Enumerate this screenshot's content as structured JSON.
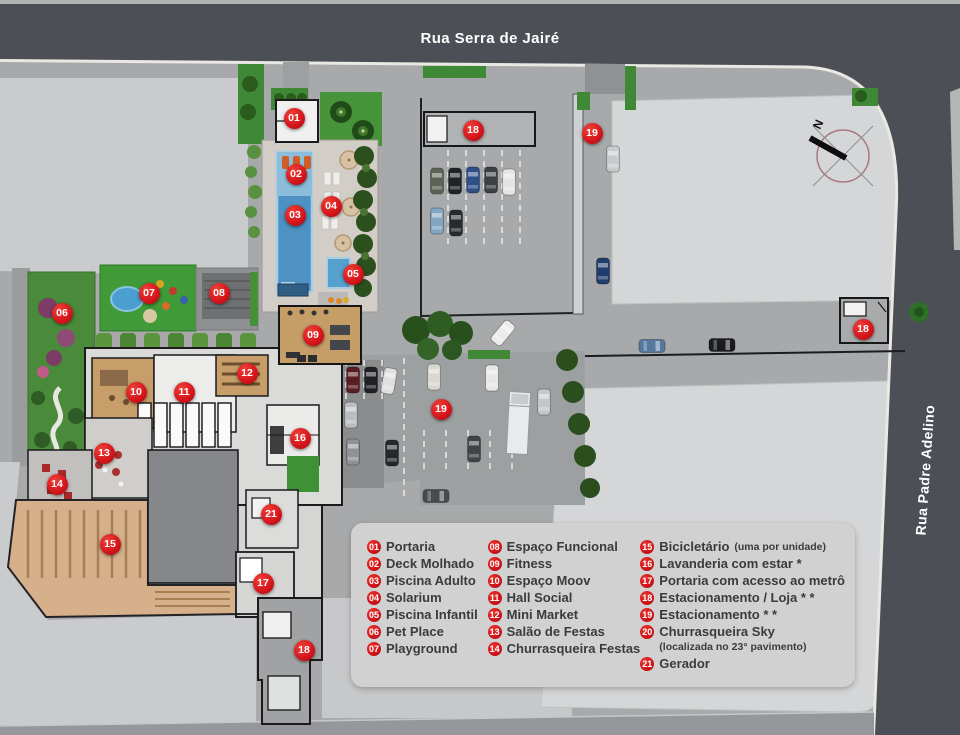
{
  "streets": {
    "top": "Rua Serra de Jairé",
    "right": "Rua Padre Adelino"
  },
  "compass": {
    "label": "N"
  },
  "colors": {
    "marker_red": "#d3131a",
    "street_dark": "#4c5056",
    "curb_white": "#e9e8e3",
    "site_ground": "#a7a9aa",
    "building_pale": "#d5d6d7",
    "legend_bg": "#d1d1d2",
    "legend_text": "#3b3a3c",
    "pool_blue": "#4e92c3",
    "lawn_green": "#479339",
    "wood_floor": "#c79e6a",
    "bike_garage_tan": "#d6b08b"
  },
  "legend": {
    "columns": [
      [
        {
          "num": "01",
          "label": "Portaria"
        },
        {
          "num": "02",
          "label": "Deck Molhado"
        },
        {
          "num": "03",
          "label": "Piscina Adulto"
        },
        {
          "num": "04",
          "label": "Solarium"
        },
        {
          "num": "05",
          "label": "Piscina Infantil"
        },
        {
          "num": "06",
          "label": "Pet Place"
        },
        {
          "num": "07",
          "label": "Playground"
        }
      ],
      [
        {
          "num": "08",
          "label": "Espaço Funcional"
        },
        {
          "num": "09",
          "label": "Fitness"
        },
        {
          "num": "10",
          "label": "Espaço Moov"
        },
        {
          "num": "11",
          "label": "Hall Social"
        },
        {
          "num": "12",
          "label": "Mini Market"
        },
        {
          "num": "13",
          "label": "Salão de Festas"
        },
        {
          "num": "14",
          "label": "Churrasqueira Festas"
        }
      ],
      [
        {
          "num": "15",
          "label": "Bicicletário",
          "note": "(uma por unidade)"
        },
        {
          "num": "16",
          "label": "Lavanderia com estar *"
        },
        {
          "num": "17",
          "label": "Portaria com acesso ao metrô"
        },
        {
          "num": "18",
          "label": "Estacionamento / Loja * *"
        },
        {
          "num": "19",
          "label": "Estacionamento * *"
        },
        {
          "num": "20",
          "label": "Churrasqueira Sky",
          "note_below": "(localizada no 23° pavimento)"
        },
        {
          "num": "21",
          "label": "Gerador"
        }
      ]
    ]
  },
  "map": {
    "markers": [
      {
        "num": "01",
        "x": 294,
        "y": 118
      },
      {
        "num": "02",
        "x": 296,
        "y": 174
      },
      {
        "num": "03",
        "x": 295,
        "y": 215
      },
      {
        "num": "04",
        "x": 331,
        "y": 206
      },
      {
        "num": "05",
        "x": 353,
        "y": 274
      },
      {
        "num": "06",
        "x": 62,
        "y": 313
      },
      {
        "num": "07",
        "x": 149,
        "y": 293
      },
      {
        "num": "08",
        "x": 219,
        "y": 293
      },
      {
        "num": "09",
        "x": 313,
        "y": 335
      },
      {
        "num": "10",
        "x": 136,
        "y": 392
      },
      {
        "num": "11",
        "x": 184,
        "y": 392
      },
      {
        "num": "12",
        "x": 247,
        "y": 373
      },
      {
        "num": "13",
        "x": 104,
        "y": 453
      },
      {
        "num": "14",
        "x": 57,
        "y": 484
      },
      {
        "num": "15",
        "x": 110,
        "y": 544
      },
      {
        "num": "16",
        "x": 300,
        "y": 438
      },
      {
        "num": "17",
        "x": 263,
        "y": 583
      },
      {
        "num": "18",
        "x": 473,
        "y": 130
      },
      {
        "num": "18",
        "x": 863,
        "y": 329
      },
      {
        "num": "18",
        "x": 304,
        "y": 650
      },
      {
        "num": "19",
        "x": 592,
        "y": 133
      },
      {
        "num": "19",
        "x": 441,
        "y": 409
      },
      {
        "num": "21",
        "x": 271,
        "y": 514
      }
    ],
    "cars": [
      {
        "x": 437,
        "y": 181,
        "a": 0,
        "c": "#5c6355"
      },
      {
        "x": 455,
        "y": 181,
        "a": 0,
        "c": "#202226"
      },
      {
        "x": 473,
        "y": 180,
        "a": 0,
        "c": "#2e4f88"
      },
      {
        "x": 491,
        "y": 180,
        "a": 0,
        "c": "#3c3f44"
      },
      {
        "x": 509,
        "y": 182,
        "a": 0,
        "c": "#e3e4e5"
      },
      {
        "x": 437,
        "y": 221,
        "a": 0,
        "c": "#82a5c2"
      },
      {
        "x": 456,
        "y": 223,
        "a": 0,
        "c": "#282a2e"
      },
      {
        "x": 613,
        "y": 159,
        "a": 0,
        "c": "#c8cacc"
      },
      {
        "x": 603,
        "y": 271,
        "a": 0,
        "c": "#1f3c6d"
      },
      {
        "x": 503,
        "y": 333,
        "a": 40,
        "c": "#ebebeb"
      },
      {
        "x": 652,
        "y": 346,
        "a": 90,
        "c": "#56789f"
      },
      {
        "x": 722,
        "y": 345,
        "a": 90,
        "c": "#1a1b1e"
      },
      {
        "x": 353,
        "y": 380,
        "a": 0,
        "c": "#5a1d22"
      },
      {
        "x": 371,
        "y": 380,
        "a": 0,
        "c": "#1e2023"
      },
      {
        "x": 389,
        "y": 381,
        "a": 10,
        "c": "#dfdfe0"
      },
      {
        "x": 434,
        "y": 377,
        "a": 0,
        "c": "#d9d7d0"
      },
      {
        "x": 492,
        "y": 378,
        "a": 0,
        "c": "#e7e7e7"
      },
      {
        "x": 351,
        "y": 415,
        "a": 0,
        "c": "#b9bdc0"
      },
      {
        "x": 353,
        "y": 452,
        "a": 0,
        "c": "#8e9295"
      },
      {
        "x": 392,
        "y": 453,
        "a": 0,
        "c": "#25272b"
      },
      {
        "x": 474,
        "y": 449,
        "a": 0,
        "c": "#404449"
      },
      {
        "x": 544,
        "y": 402,
        "a": 0,
        "c": "#c5c7c9"
      },
      {
        "x": 436,
        "y": 496,
        "a": 90,
        "c": "#474a4e"
      }
    ]
  }
}
